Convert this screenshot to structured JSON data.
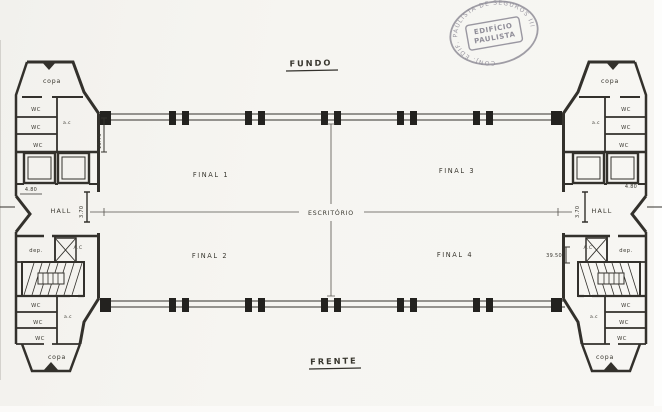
{
  "stamp": {
    "ring_text": "CONJ. EDIF. PAULISTA DE SEGUROS III",
    "center_line1": "EDIFÍCIO",
    "center_line2": "PAULISTA"
  },
  "orientation": {
    "top": "FUNDO",
    "bottom": "FRENTE"
  },
  "office": {
    "center": "ESCRITÓRIO",
    "final_1": "FINAL 1",
    "final_2": "FINAL 2",
    "final_3": "FINAL 3",
    "final_4": "FINAL 4"
  },
  "left_wing": {
    "copa_top": "copa",
    "wc_top": [
      "WC",
      "WC",
      "WC"
    ],
    "ac_top": "a.c",
    "hall": "HALL",
    "dep": "dep.",
    "ac_shaft": "A.C",
    "wc_bottom": [
      "WC",
      "WC",
      "WC"
    ],
    "ac_bottom": "a.c",
    "copa_bottom": "copa",
    "dims": {
      "bay_height": "15.75",
      "elevator": "4.80",
      "hall_width": "3.70"
    }
  },
  "right_wing": {
    "copa_top": "copa",
    "wc_top": [
      "WC",
      "WC",
      "WC"
    ],
    "ac_top": "a.c",
    "hall": "HALL",
    "dep": "dep.",
    "ac_shaft": "A.C",
    "wc_bottom": [
      "WC",
      "WC",
      "WC"
    ],
    "ac_bottom": "a.c",
    "copa_bottom": "copa",
    "dims": {
      "elevator": "4.80",
      "hall_width": "3.70",
      "total": "39.50"
    }
  },
  "colors": {
    "ink": "#33312c",
    "stamp": "#8f8d98",
    "paper": "#f5f4f0"
  }
}
